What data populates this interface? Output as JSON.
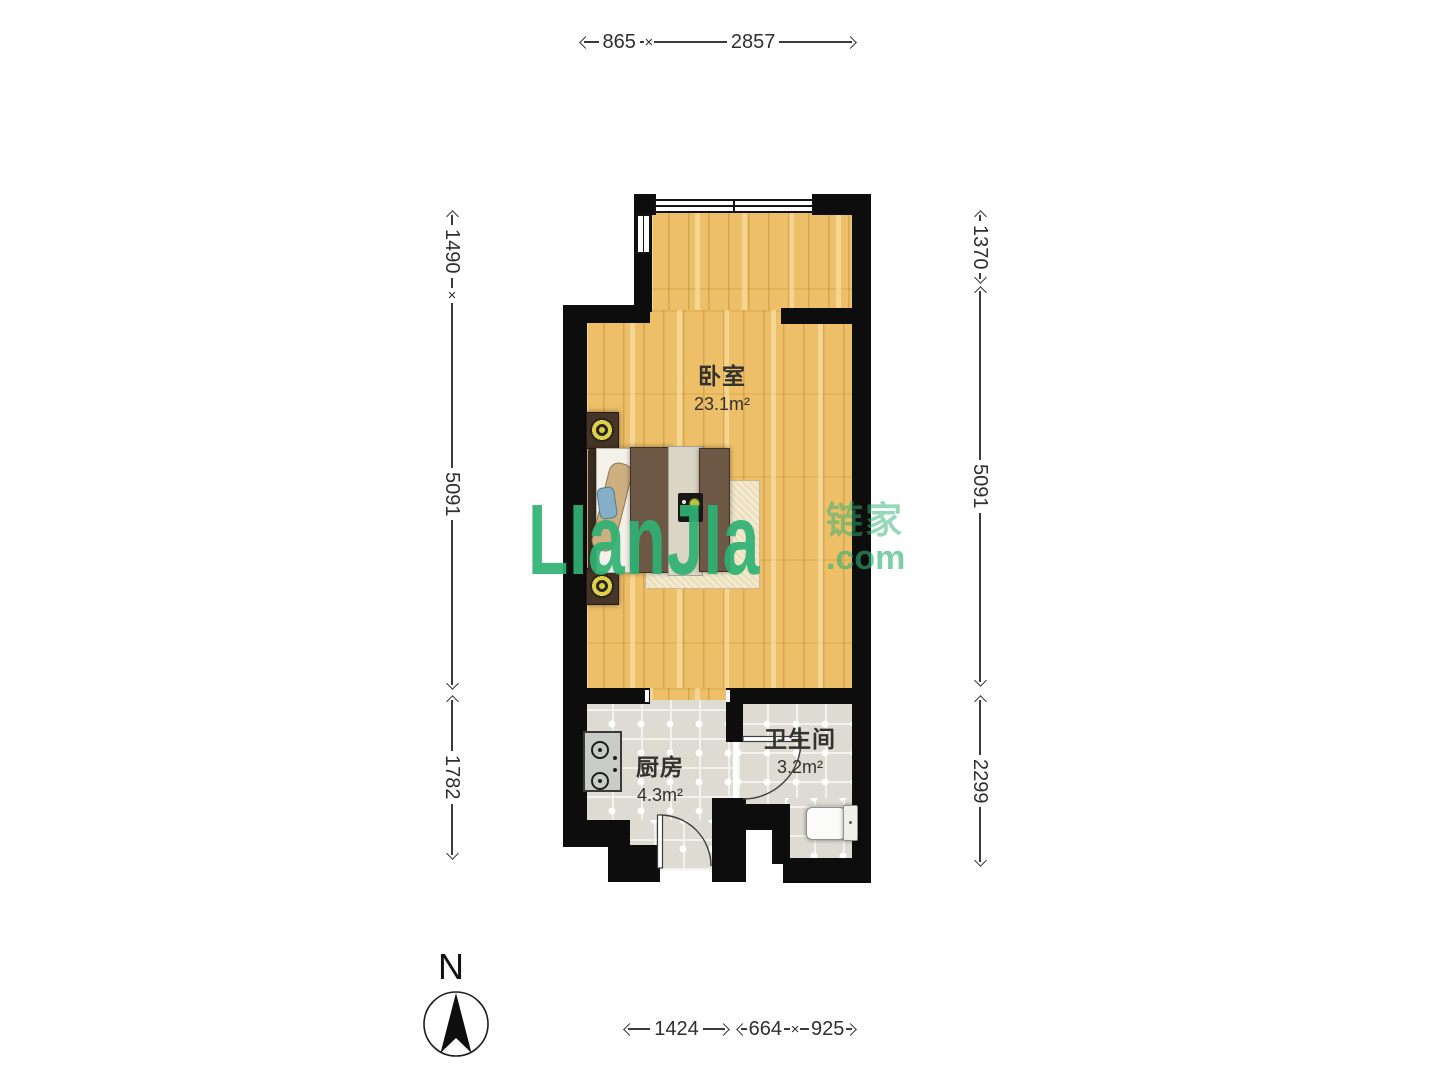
{
  "watermark": {
    "brand": "LIanJIa",
    "brand_cjk": "链家",
    "domain_suffix": ".com"
  },
  "compass": {
    "label": "N"
  },
  "rooms": [
    {
      "name": "卧室",
      "area": "23.1m²"
    },
    {
      "name": "厨房",
      "area": "4.3m²"
    },
    {
      "name": "卫生间",
      "area": "3.2m²"
    }
  ],
  "dimensions": {
    "top": [
      "865",
      "2857"
    ],
    "bottom": [
      "1424",
      "664",
      "925"
    ],
    "left": [
      "1490",
      "5091",
      "1782"
    ],
    "right": [
      "1370",
      "5091",
      "2299"
    ],
    "cross_mark": "×"
  },
  "colors": {
    "wall": "#0d0d0d",
    "wood_floor": "#ecbf68",
    "tile_floor": "#dedbd3",
    "brand_green": "#2fb173",
    "dimension_text": "#2f2f2f"
  }
}
